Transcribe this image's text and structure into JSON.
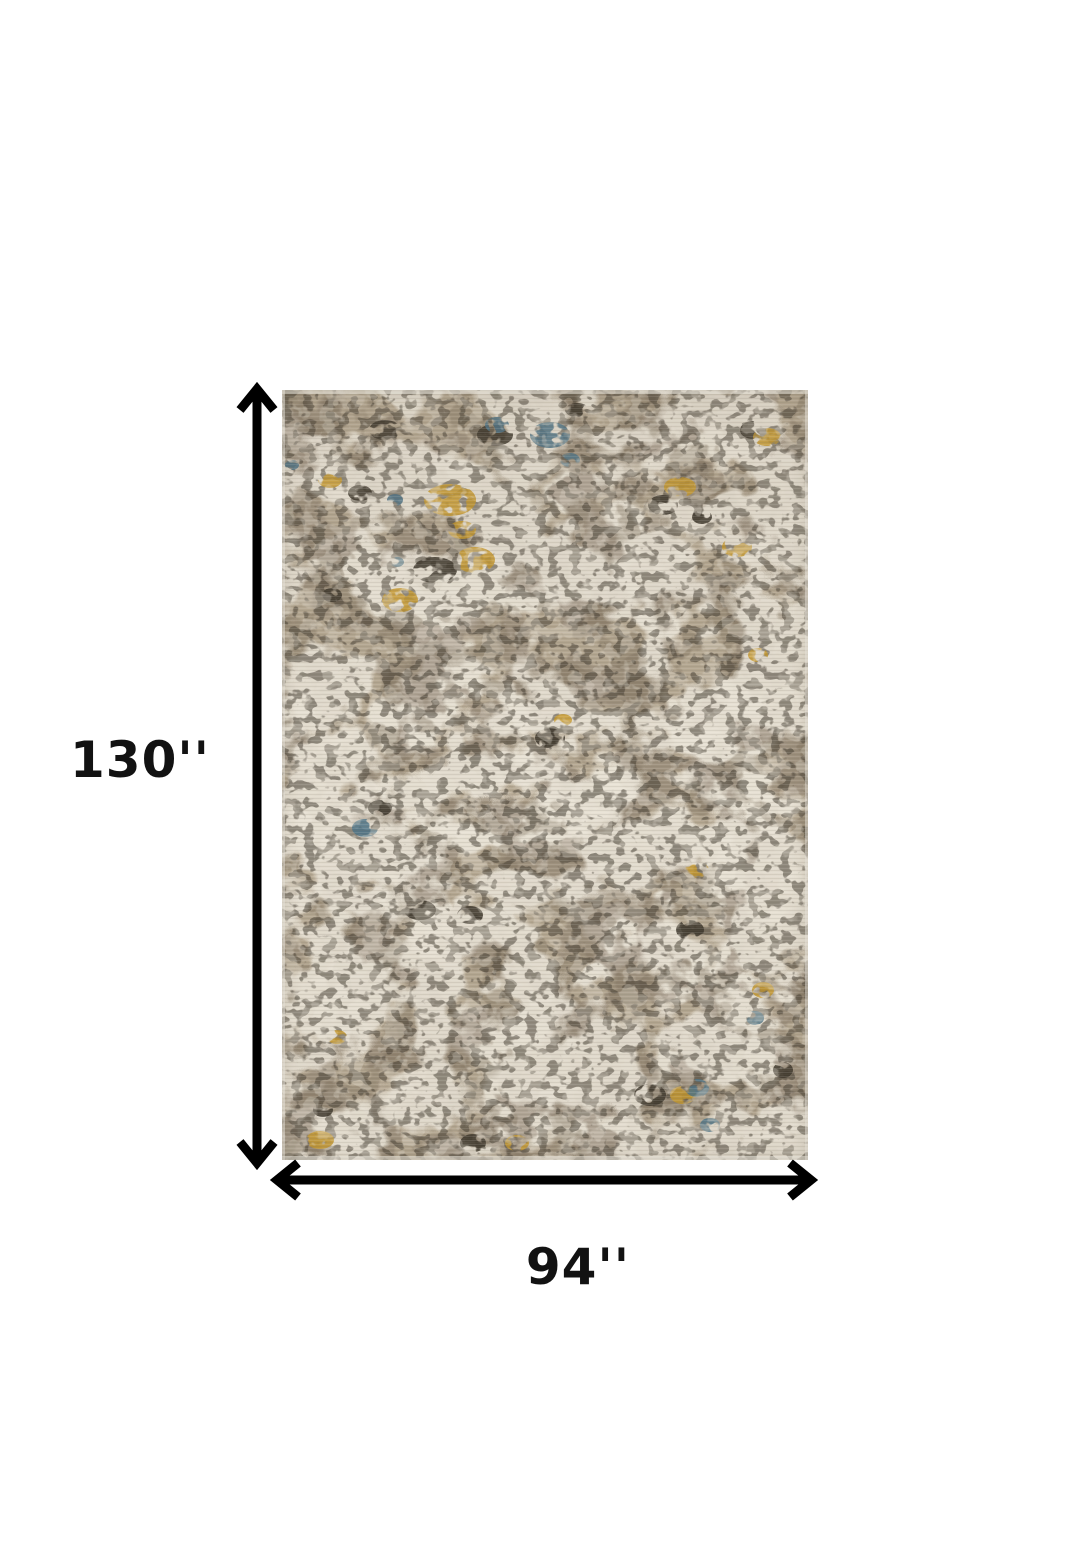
{
  "diagram": {
    "height_label": "130''",
    "width_label": "94''",
    "arrow_color": "#000000",
    "label_color": "#121212",
    "rug": {
      "palette": {
        "ivory_base": "#e6e0d2",
        "taupe": "#b2a48e",
        "gray_brown": "#8e8171",
        "mid_brown": "#7d6f5c",
        "charcoal": "#3b342a",
        "gold": "#c6992e",
        "blue": "#4d7386",
        "cream_erase": "#e9e3d6"
      }
    }
  }
}
